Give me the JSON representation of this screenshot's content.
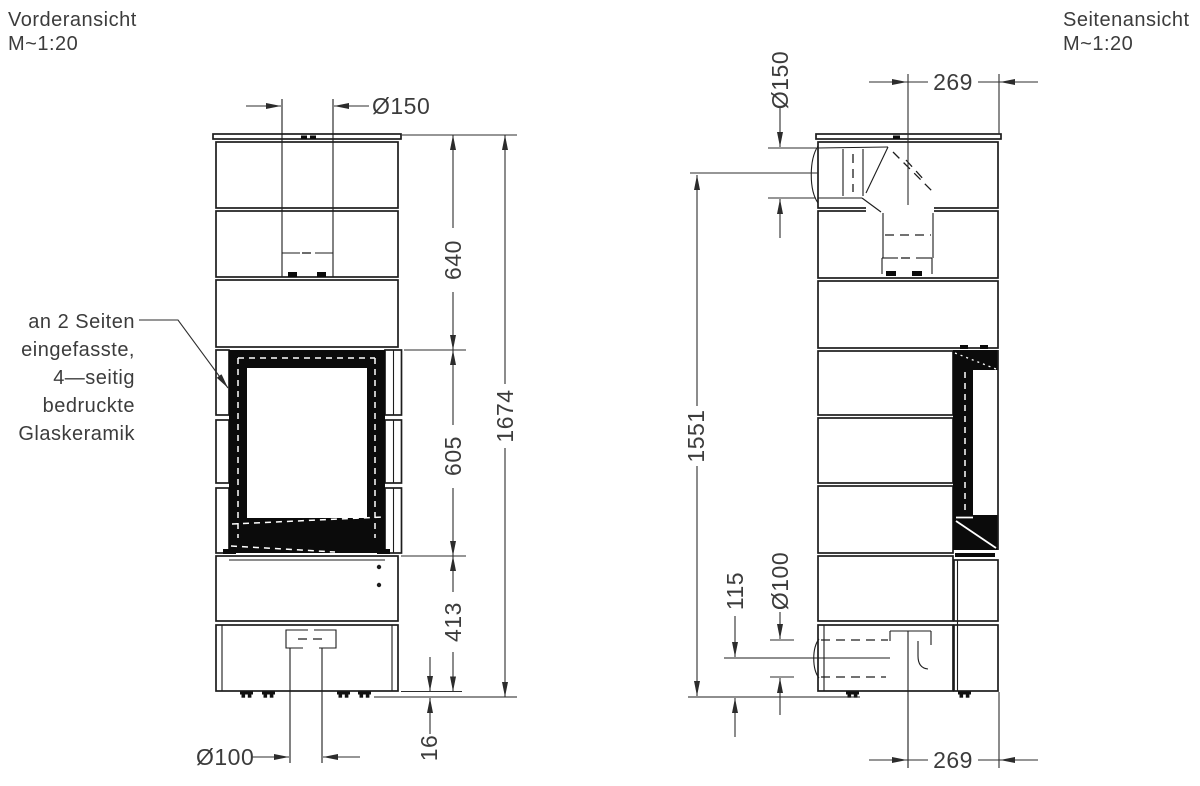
{
  "drawing": {
    "front": {
      "title": "Vorderansicht",
      "scale": "M~1:20",
      "annotation": [
        "an 2 Seiten",
        "eingefasste,",
        "4—seitig",
        "bedruckte",
        "Glaskeramik"
      ],
      "dims": {
        "flue_diameter": "Ø150",
        "upper_height": "640",
        "window_height": "605",
        "base_height": "413",
        "total_height": "1674",
        "air_diameter": "Ø100",
        "plinth_height": "16"
      }
    },
    "side": {
      "title": "Seitenansicht",
      "scale": "M~1:20",
      "dims": {
        "flue_diameter": "Ø150",
        "flue_offset_top": "269",
        "flue_center_height": "1551",
        "air_center_height": "115",
        "air_diameter": "Ø100",
        "air_offset_bottom": "269"
      }
    },
    "colors": {
      "line": "#1d1d1d",
      "text": "#3c3c3c",
      "glass_frame": "#0b0b0b",
      "background": "#ffffff"
    }
  }
}
